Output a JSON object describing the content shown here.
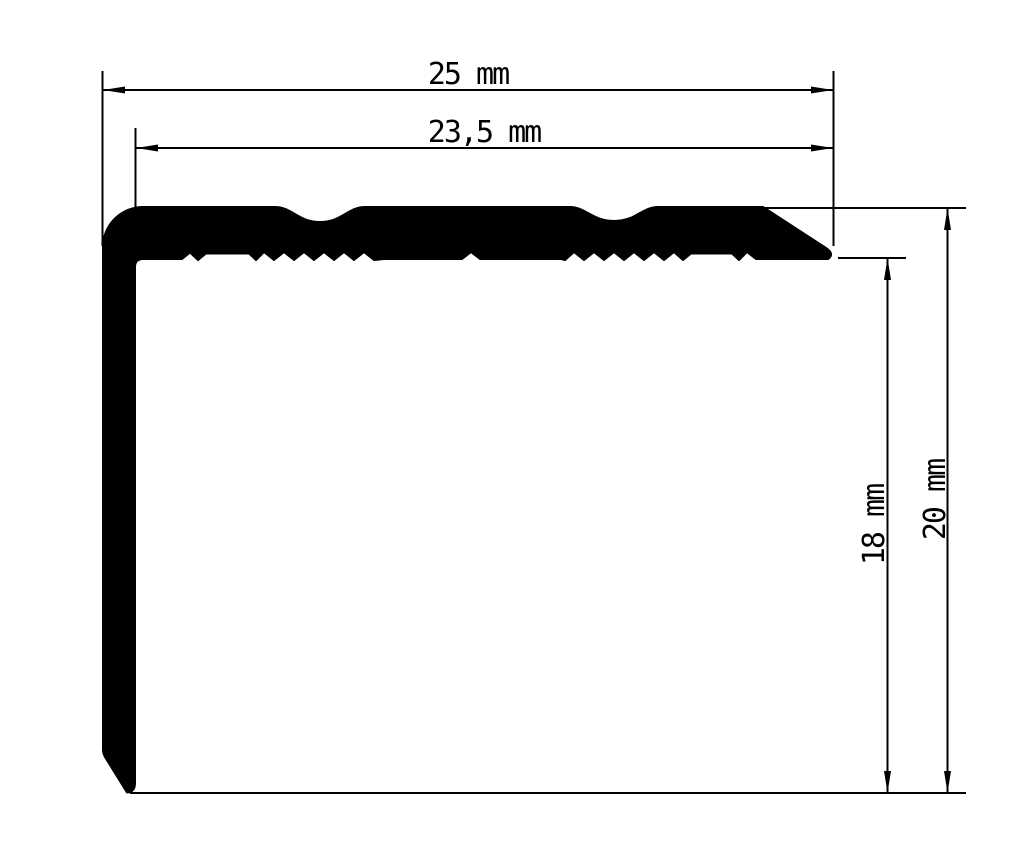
{
  "drawing": {
    "description": "Technical cross-section drawing of a black L-shaped stair nosing profile with ribbed underside and two shallow grooves on the tread surface",
    "unit": "mm",
    "ink_color": "#000000",
    "background_color": "#ffffff",
    "dimensions": {
      "outer_width": {
        "label": "25 mm",
        "value": 25,
        "orientation": "horizontal",
        "measures": "overall width of profile"
      },
      "inner_width": {
        "label": "23,5 mm",
        "value": 23.5,
        "orientation": "horizontal",
        "measures": "width from inner face of leg to right tip"
      },
      "inner_height": {
        "label": "18 mm",
        "value": 18,
        "orientation": "vertical",
        "measures": "height from underside of top flange to leg tip"
      },
      "outer_height": {
        "label": "20 mm",
        "value": 20,
        "orientation": "vertical",
        "measures": "overall height of profile"
      }
    }
  }
}
